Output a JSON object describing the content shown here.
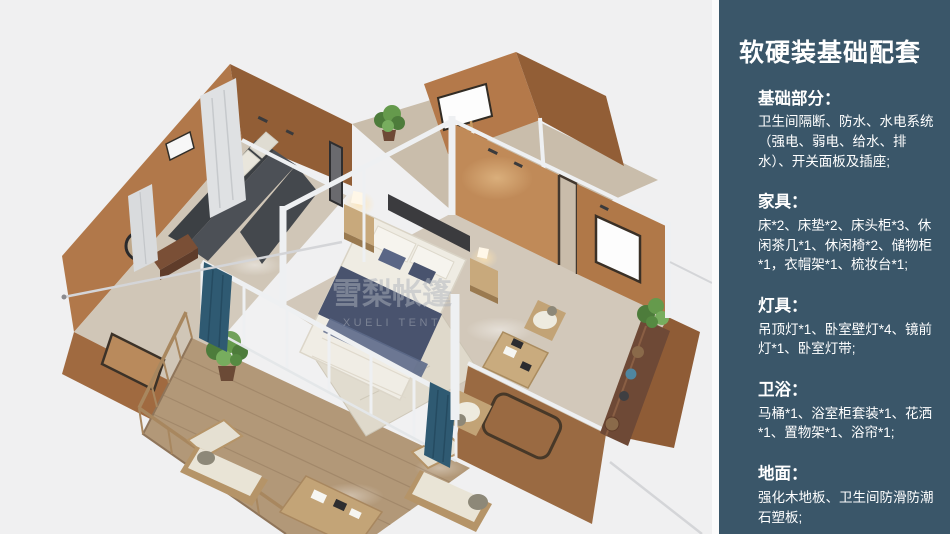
{
  "window": {
    "width": 950,
    "height": 534
  },
  "viewer": {
    "description": "isometric 3d floor plan render of glamping tent house",
    "watermark": {
      "line1": "雪梨帐篷",
      "line2": "XUELI TENT"
    },
    "colors": {
      "background": "#f0f0f1",
      "wall_lit": "#c08a58",
      "wall_mid": "#b1784a",
      "wall_dark": "#925e36",
      "floor_wood": "#d2c8ba",
      "deck_wood": "#b29878",
      "frame_white": "#eef0f2",
      "sofa_dark": "#4c5056",
      "bed_white": "#efece3",
      "bed_navy": "#49536e",
      "rug": "#dfd9cb",
      "plant_green": "#4d7c3b",
      "curtain_gray": "#dfe1e3",
      "curtain_teal": "#2f5a72",
      "sideboard_walnut": "#6e4936",
      "table_wood": "#c9ab7e"
    }
  },
  "sidebar": {
    "bg": "#3a5669",
    "text_color": "#ffffff",
    "title": "软硬装基础配套",
    "sections": [
      {
        "heading": "基础部分：",
        "body": "卫生间隔断、防水、水电系统（强电、弱电、给水、排水）、开关面板及插座;"
      },
      {
        "heading": "家具：",
        "body": "床*2、床垫*2、床头柜*3、休闲茶几*1、休闲椅*2、储物柜*1，衣帽架*1、梳妆台*1;"
      },
      {
        "heading": "灯具：",
        "body": "吊顶灯*1、卧室壁灯*4、镜前灯*1、卧室灯带;"
      },
      {
        "heading": "卫浴：",
        "body": "马桶*1、浴室柜套装*1、花洒*1、置物架*1、浴帘*1;"
      },
      {
        "heading": "地面：",
        "body": "强化木地板、卫生间防滑防潮石塑板;"
      }
    ]
  }
}
